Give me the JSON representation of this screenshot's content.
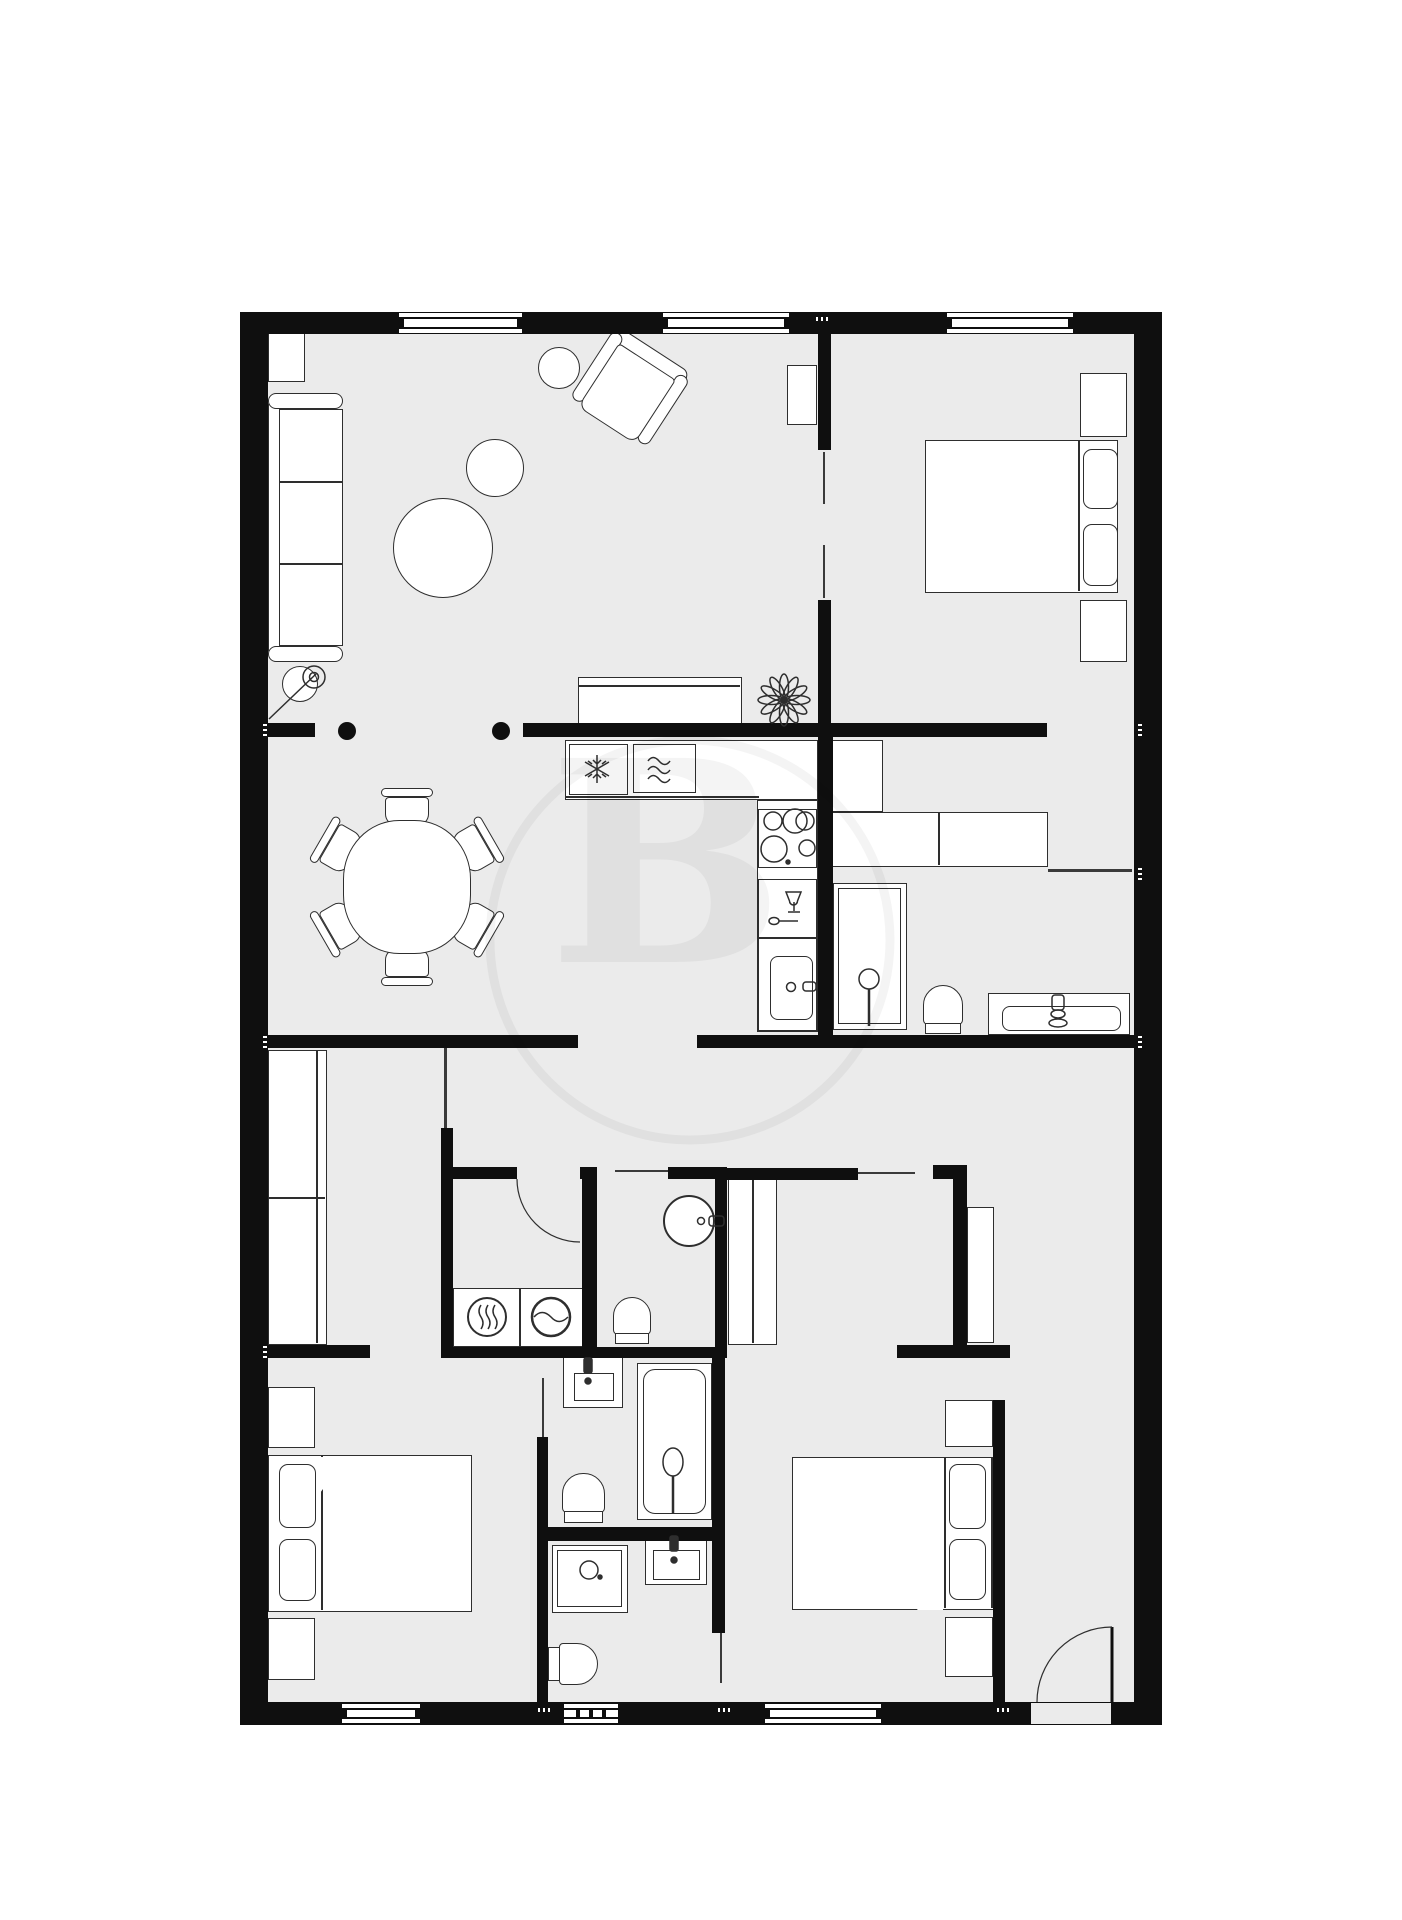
{
  "meta": {
    "title": "apartment-floor-plan",
    "kind": "architectural floor plan, top view, black and white"
  },
  "watermark": {
    "letter": "B"
  },
  "palette": {
    "background": "#ffffff",
    "floor": "#ebebeb",
    "wall": "#0f0f0f",
    "furniture_fill": "#ffffff",
    "furniture_line": "#2e2e2e"
  },
  "rooms": [
    {
      "name": "living-room",
      "furniture": [
        "sofa",
        "armchair",
        "floor-lamp",
        "coffee-table-large",
        "coffee-table-medium",
        "side-table",
        "sideboard",
        "wall-shelf",
        "plant",
        "column",
        "column"
      ]
    },
    {
      "name": "dining-area",
      "furniture": [
        "round-dining-table",
        "dining-chair",
        "dining-chair",
        "dining-chair",
        "dining-chair",
        "dining-chair",
        "dining-chair"
      ]
    },
    {
      "name": "kitchen",
      "furniture": [
        "refrigerator",
        "oven",
        "counter",
        "cooktop",
        "dishwasher",
        "kitchen-sink"
      ]
    },
    {
      "name": "bedroom-top-right",
      "furniture": [
        "double-bed",
        "nightstand",
        "nightstand",
        "wall-shelf"
      ]
    },
    {
      "name": "ensuite-bathroom",
      "furniture": [
        "tall-cabinet",
        "vanity-cabinet",
        "shower",
        "toilet",
        "sink-vanity"
      ]
    },
    {
      "name": "wc",
      "furniture": [
        "round-basin",
        "toilet"
      ]
    },
    {
      "name": "laundry-room",
      "furniture": [
        "dryer",
        "washing-machine"
      ]
    },
    {
      "name": "bedroom-bottom-left",
      "furniture": [
        "double-bed",
        "nightstand",
        "nightstand",
        "wardrobe"
      ]
    },
    {
      "name": "bathroom-with-bathtub",
      "furniture": [
        "sink",
        "bathtub",
        "toilet"
      ]
    },
    {
      "name": "bathroom-with-shower",
      "furniture": [
        "shower",
        "sink",
        "toilet"
      ]
    },
    {
      "name": "bedroom-bottom-right",
      "furniture": [
        "double-bed",
        "nightstand",
        "nightstand",
        "hall-wardrobe"
      ]
    },
    {
      "name": "entry-hall",
      "furniture": [
        "wardrobe",
        "entrance-door"
      ]
    }
  ]
}
